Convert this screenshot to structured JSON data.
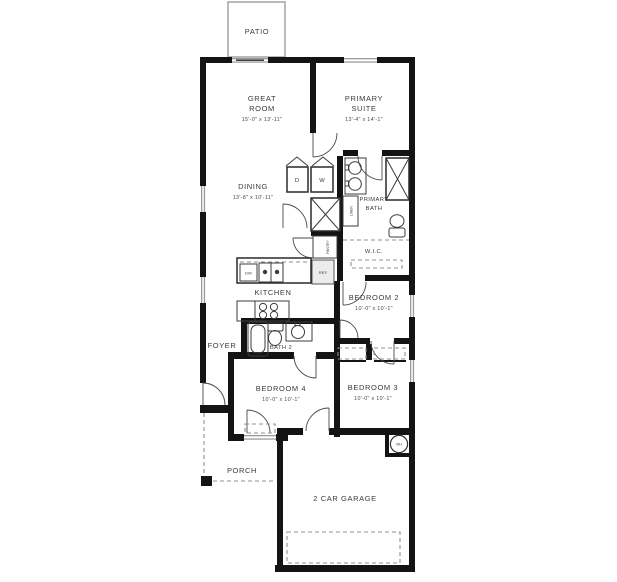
{
  "rooms": {
    "patio": "PATIO",
    "great_room": {
      "l1": "GREAT",
      "l2": "ROOM",
      "dims": "15'-0\" x 13'-11\""
    },
    "primary_suite": {
      "l1": "PRIMARY",
      "l2": "SUITE",
      "dims": "13'-4\" x 14'-1\""
    },
    "dining": {
      "l1": "DINING",
      "dims": "13'-8\" x 10'-11\""
    },
    "kitchen": "KITCHEN",
    "foyer": "FOYER",
    "bath2": "BATH 2",
    "primary_bath": {
      "l1": "PRIMARY",
      "l2": "BATH"
    },
    "wic": "W.I.C.",
    "bedroom2": {
      "l1": "BEDROOM 2",
      "dims": "10'-0\" x 10'-1\""
    },
    "bedroom3": {
      "l1": "BEDROOM 3",
      "dims": "10'-0\" x 10'-1\""
    },
    "bedroom4": {
      "l1": "BEDROOM 4",
      "dims": "10'-0\" x 10'-1\""
    },
    "porch": "PORCH",
    "garage": "2 CAR GARAGE"
  },
  "fixtures": {
    "dryer": "D",
    "washer": "W",
    "dishwasher": "DW",
    "refrigerator": "REF",
    "water_heater": "WH",
    "linen": "LINEN",
    "pantry": "PANTRY"
  },
  "colors": {
    "wall": "#141414",
    "window": "#9c9c9c",
    "fixture_line": "#3c3c3c",
    "dashed_line": "#8f8f8f",
    "patio_outline": "#a8a8a8",
    "text": "#3b3b3b",
    "background": "#ffffff"
  }
}
